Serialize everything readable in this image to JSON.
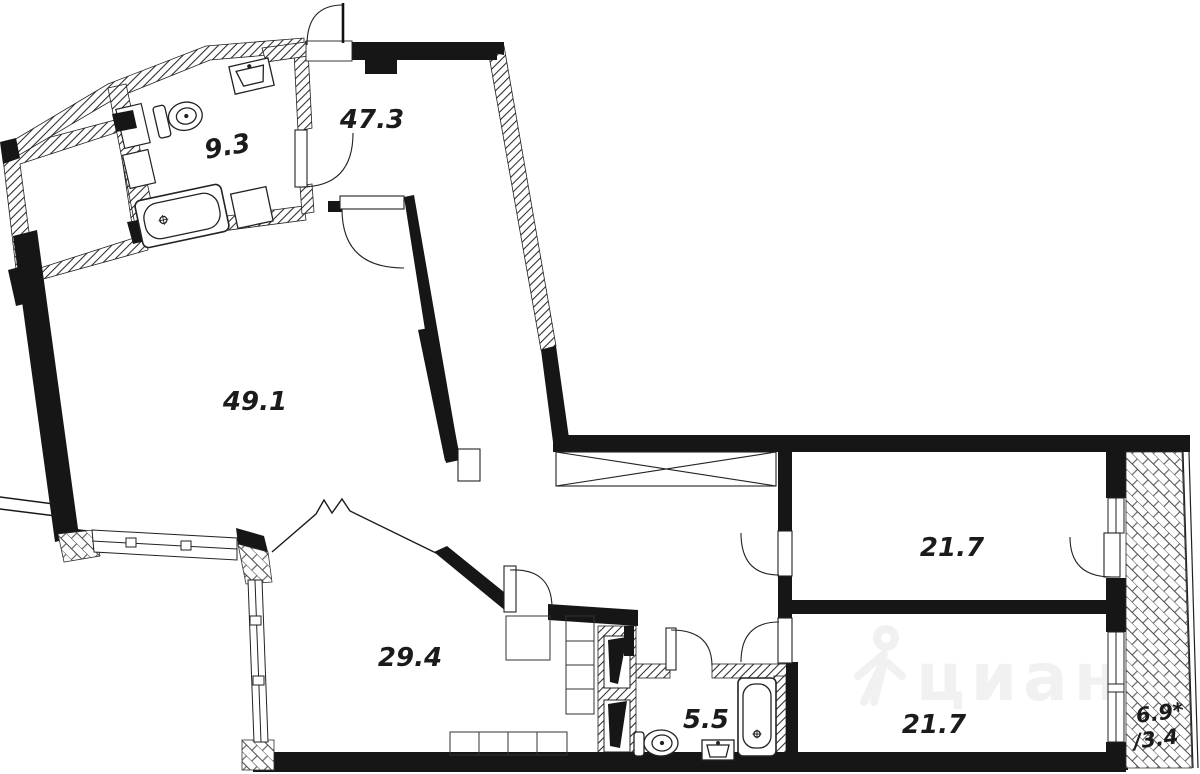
{
  "plan": {
    "type": "apartment-floor-plan",
    "colors": {
      "wall": "#161616",
      "line": "#222222",
      "background": "#ffffff",
      "watermark": "#f1f1f1"
    },
    "watermark": {
      "text": "циан"
    },
    "rooms": [
      {
        "name": "bathroom-top",
        "area": "9.3"
      },
      {
        "name": "hall-top",
        "area": "47.3"
      },
      {
        "name": "living-room",
        "area": "49.1"
      },
      {
        "name": "kitchen-living",
        "area": "29.4"
      },
      {
        "name": "bathroom-bottom",
        "area": "5.5"
      },
      {
        "name": "bedroom-right-top",
        "area": "21.7"
      },
      {
        "name": "bedroom-right-bottom",
        "area": "21.7"
      },
      {
        "name": "balcony",
        "area": "6.9*",
        "area_secondary": "/3.4"
      }
    ]
  }
}
